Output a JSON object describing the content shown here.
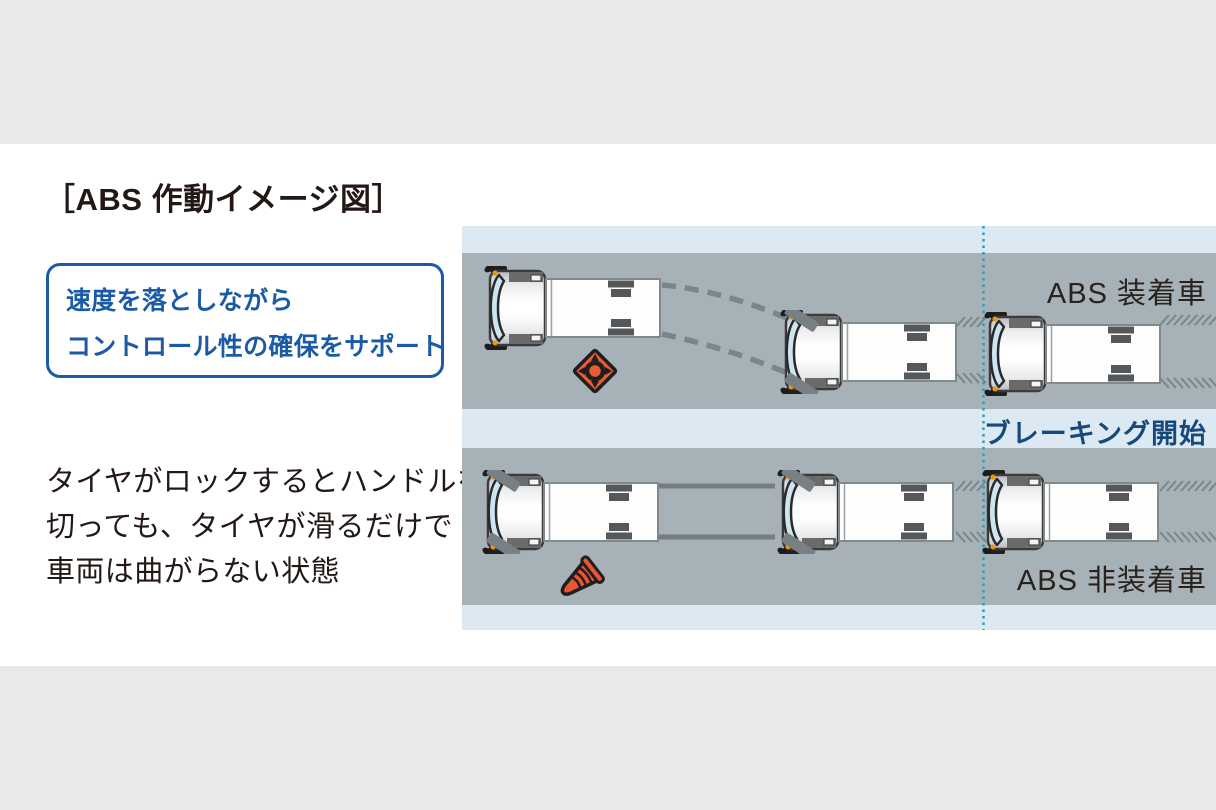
{
  "page": {
    "background": "#ffffff",
    "top_bar_color": "#e9e9e9",
    "bottom_bar_color": "#e9e9e9"
  },
  "title": "［ABS 作動イメージ図］",
  "callout": {
    "line1": "速度を落としながら",
    "line2": "コントロール性の確保をサポート",
    "accent_color": "#1b5aa5"
  },
  "description": {
    "line1": "タイヤがロックするとハンドルを",
    "line2": "切っても、タイヤが滑るだけで",
    "line3": "車両は曲がらない状態",
    "text_color": "#231815"
  },
  "diagram": {
    "abs_lane_label": "ABS 装着車",
    "braking_start_label": "ブレーキング開始",
    "non_abs_lane_label": "ABS 非装着車",
    "road_color": "#a7b1b8",
    "shoulder_color": "#dce9f3",
    "braking_line_color": "#2f9dae",
    "obstacle_color": "#ec5a35",
    "skid_mark_color": "#7b858b",
    "icons": [
      "truck-top-view",
      "hazard-diamond-icon",
      "fallen-cone-icon",
      "braking-start-dotted-line"
    ]
  }
}
